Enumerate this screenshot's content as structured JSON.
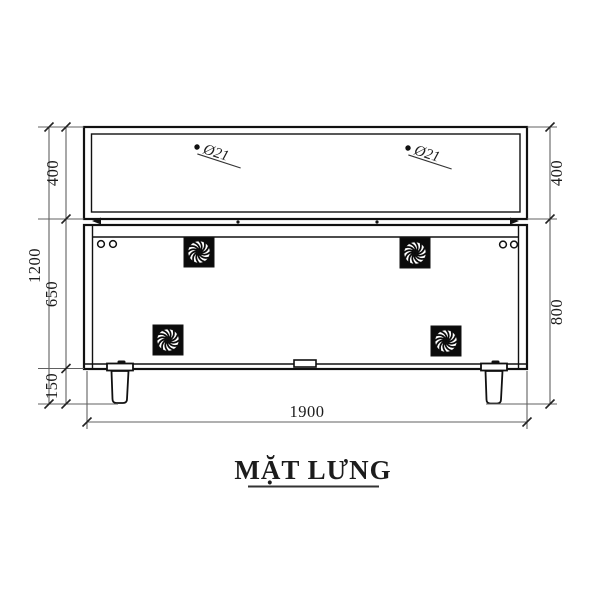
{
  "title": {
    "text": "MẶT LƯNG"
  },
  "hole_labels": {
    "left": "Ø21",
    "right": "Ø21"
  },
  "dimensions": {
    "overall_height": "1200",
    "upper_height": "400",
    "middle_height": "650",
    "leg_height": "150",
    "right_upper": "400",
    "right_lower": "800",
    "width": "1900"
  },
  "symbols": {
    "fan_vent_count": 4,
    "screw_hole_count": 4
  },
  "colors": {
    "line": "#111111",
    "dim_line": "#606060",
    "tick": "#222222",
    "text": "#1c1c1c",
    "fan_fill": "#0b0b0b"
  }
}
